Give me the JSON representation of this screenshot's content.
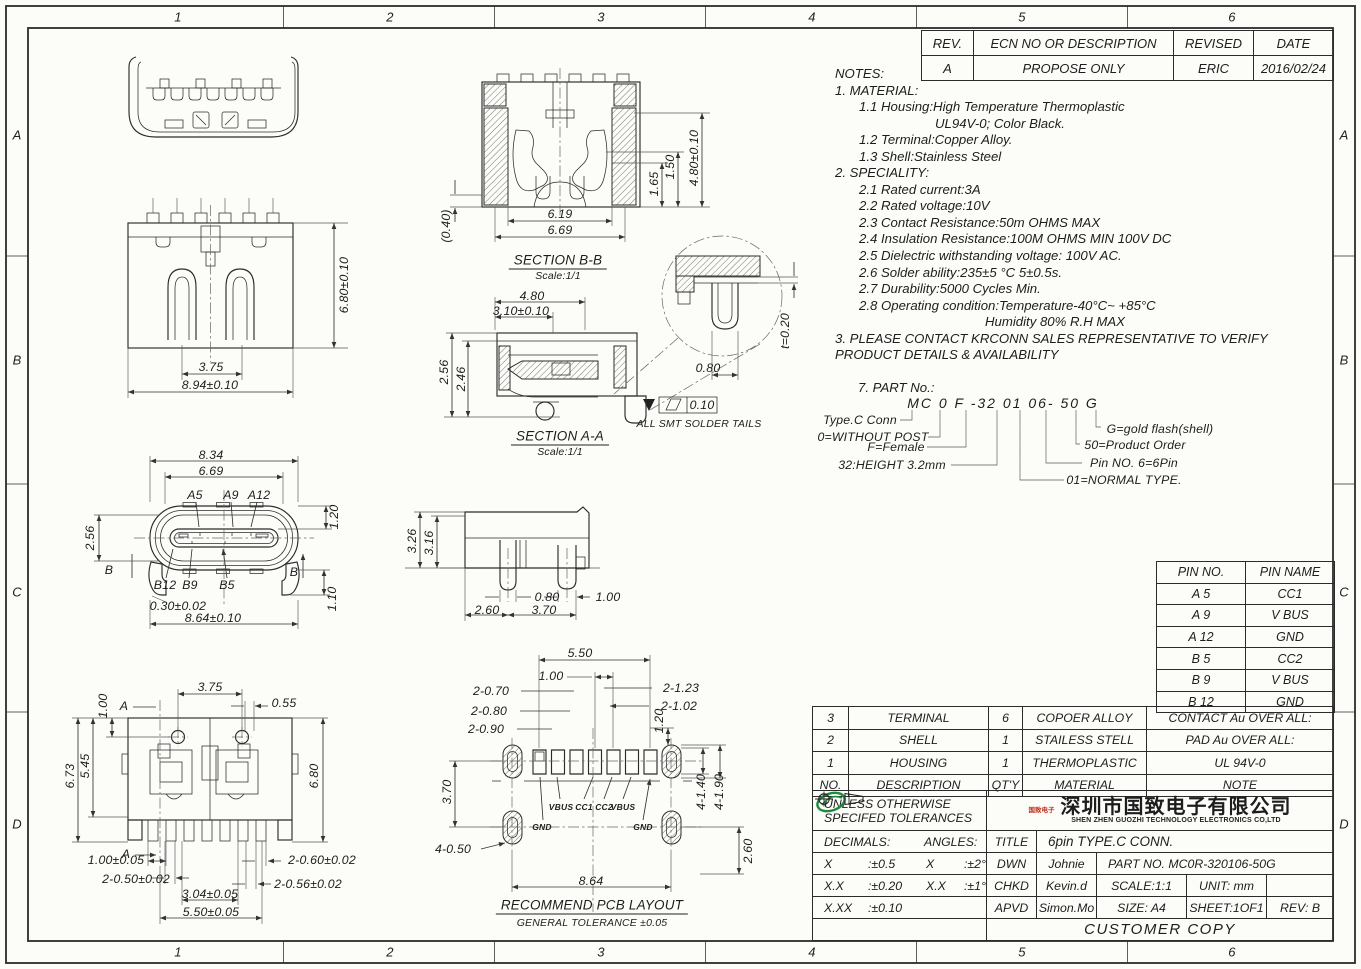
{
  "border": {
    "cols": [
      "1",
      "2",
      "3",
      "4",
      "5",
      "6"
    ],
    "rows": [
      "A",
      "B",
      "C",
      "D"
    ]
  },
  "revision": {
    "headers": [
      "REV.",
      "ECN NO OR DESCRIPTION",
      "REVISED",
      "DATE"
    ],
    "row": [
      "A",
      "PROPOSE ONLY",
      "ERIC",
      "2016/02/24"
    ]
  },
  "notes": {
    "lines": [
      "NOTES:",
      "1. MATERIAL:",
      "1.1 Housing:High Temperature Thermoplastic",
      "UL94V-0; Color Black.",
      "1.2 Terminal:Copper Alloy.",
      "1.3 Shell:Stainless Steel",
      "2. SPECIALITY:",
      "2.1 Rated current:3A",
      "2.2 Rated voltage:10V",
      "2.3 Contact Resistance:50m OHMS MAX",
      "2.4 Insulation Resistance:100M OHMS MIN 100V DC",
      "2.5 Dielectric withstanding voltage: 100V AC.",
      "2.6 Solder ability:235±5 °C 5±0.5s.",
      "2.7 Durability:5000 Cycles Min.",
      "2.8 Operating condition:Temperature-40°C~ +85°C",
      "Humidity 80% R.H MAX",
      "3. PLEASE CONTACT KRCONN SALES REPRESENTATIVE TO VERIFY",
      "PRODUCT DETAILS & AVAILABILITY"
    ]
  },
  "part_no": {
    "heading": "7. PART No.:",
    "code": "MC 0  F -32 01 06- 50 G",
    "left_labels": [
      "Type.C Conn",
      "0=WITHOUT POST",
      "F=Female",
      "32:HEIGHT 3.2mm"
    ],
    "right_labels": [
      "G=gold flash(shell)",
      "50=Product Order",
      "Pin NO. 6=6Pin",
      "01=NORMAL TYPE."
    ]
  },
  "pin_table": {
    "headers": [
      "PIN NO.",
      "PIN NAME"
    ],
    "rows": [
      [
        "A 5",
        "CC1"
      ],
      [
        "A 9",
        "V BUS"
      ],
      [
        "A 12",
        "GND"
      ],
      [
        "B 5",
        "CC2"
      ],
      [
        "B 9",
        "V BUS"
      ],
      [
        "B 12",
        "GND"
      ]
    ]
  },
  "bom": {
    "rows": [
      [
        "3",
        "TERMINAL",
        "6",
        "COPOER ALLOY",
        "CONTACT Au OVER ALL:"
      ],
      [
        "2",
        "SHELL",
        "1",
        "STAILESS STELL",
        "PAD Au OVER ALL:"
      ],
      [
        "1",
        "HOUSING",
        "1",
        "THERMOPLASTIC",
        "UL 94V-0"
      ],
      [
        "NO.",
        "DESCRIPTION",
        "QT'Y",
        "MATERIAL",
        "NOTE"
      ]
    ]
  },
  "title_block": {
    "tol_title1": "UNLESS OTHERWISE",
    "tol_title2": "SPECIFED TOLERANCES",
    "company_cn": "深圳市国致电子有限公司",
    "company_en": "SHEN ZHEN GUOZHI TECHNOLOGY ELECTRONICS CO,LTD",
    "logo_text": "国致电子",
    "decimals_label": "DECIMALS:",
    "angles_label": "ANGLES:",
    "tol_rows": [
      [
        "X",
        ":±0.5",
        "X",
        ":±2°"
      ],
      [
        "X.X",
        ":±0.20",
        "X.X",
        ":±1°"
      ],
      [
        "X.XX",
        ":±0.10",
        "",
        ""
      ]
    ],
    "title_label": "TITLE",
    "title_value": "6pin TYPE.C CONN.",
    "dwn_label": "DWN",
    "dwn_value": "Johnie",
    "part_no_value": "PART NO. MC0R-320106-50G",
    "chkd_label": "CHKD",
    "chkd_value": "Kevin.d",
    "scale_value": "SCALE:1:1",
    "unit_value": "UNIT:  mm",
    "apvd_label": "APVD",
    "apvd_value": "Simon.Mo",
    "size_value": "SIZE: A4",
    "sheet_value": "SHEET:1OF1",
    "rev_value": "REV: B",
    "customer_copy": "CUSTOMER COPY"
  },
  "captions": {
    "bb": "SECTION B-B",
    "bb_scale": "Scale:1/1",
    "aa": "SECTION A-A",
    "aa_scale": "Scale:1/1",
    "pcb": "RECOMMEND PCB LAYOUT",
    "pcb_tol": "GENERAL TO­LERANCE ±0.05",
    "smt": "ALL SMT SOLDER TAILS",
    "flat": "0.10"
  },
  "dims": {
    "back_h": "6.80±0.10",
    "back_w1": "3.75",
    "back_w2": "8.94±0.10",
    "bb_040": "(0.40)",
    "bb_619": "6.19",
    "bb_669": "6.69",
    "bb_165": "1.65",
    "bb_150": "1.50",
    "bb_480": "4.80±0.10",
    "aa_480": "4.80",
    "aa_310": "3.10±0.10",
    "aa_256": "2.56",
    "aa_246": "2.46",
    "det_080": "0.80",
    "det_t": "t=0.20",
    "fr_834": "8.34",
    "fr_669": "6.69",
    "fr_a5": "A5",
    "fr_a9": "A9",
    "fr_a12": "A12",
    "fr_120": "1.20",
    "fr_256": "2.56",
    "fr_b12": "B12",
    "fr_b9": "B9",
    "fr_b5": "B5",
    "fr_030": "0.30±0.02",
    "fr_864": "8.64±0.10",
    "fr_110": "1.10",
    "fr_bl": "B",
    "fr_br": "B",
    "sv_326": "3.26",
    "sv_316": "3.16",
    "sv_080": "0.80",
    "sv_100": "1.00",
    "sv_260": "2.60",
    "sv_370": "3.70",
    "bt_100": "1.00",
    "bt_a1": "A",
    "bt_375": "3.75",
    "bt_055": "0.55",
    "bt_673": "6.73",
    "bt_545": "5.45",
    "bt_680": "6.80",
    "bt_a2": "A",
    "bt_t100": "1.00±0.05",
    "bt_t050": "2-0.50±0.02",
    "bt_t060": "2-0.60±0.02",
    "bt_t056": "2-0.56±0.02",
    "bt_t304": "3.04±0.05",
    "bt_t550": "5.50±0.05",
    "pcb_550": "5.50",
    "pcb_100": "1.00",
    "pcb_070": "2-0.70",
    "pcb_080": "2-0.80",
    "pcb_090": "2-0.90",
    "pcb_123": "2-1.23",
    "pcb_102": "2-1.02",
    "pcb_120": "1.20",
    "pcb_370": "3.70",
    "pcb_140": "4-1.40",
    "pcb_190": "4-1.90",
    "pcb_260": "2.60",
    "pcb_050": "4-0.50",
    "pcb_864": "8.64",
    "pcb_vbus1": "VBUS",
    "pcb_cc1": "CC1",
    "pcb_cc2": "CC2",
    "pcb_vbus2": "VBUS",
    "pcb_gnd1": "GND",
    "pcb_gnd2": "GND"
  }
}
